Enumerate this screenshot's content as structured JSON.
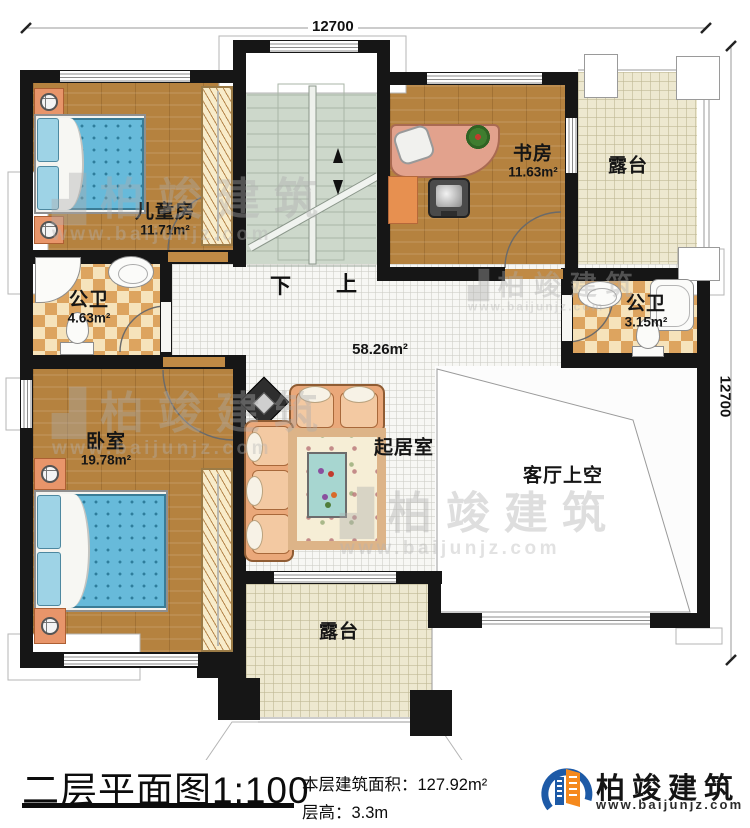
{
  "dimensions": {
    "top": "12700",
    "right": "12700"
  },
  "rooms": {
    "children": {
      "name": "儿童房",
      "area": "11.71m²"
    },
    "study": {
      "name": "书房",
      "area": "11.63m²"
    },
    "terrace_top": {
      "name": "露台"
    },
    "bath_left": {
      "name": "公卫",
      "area": "4.63m²"
    },
    "bath_right": {
      "name": "公卫",
      "area": "3.15m²"
    },
    "bedroom": {
      "name": "卧室",
      "area": "19.78m²"
    },
    "living": {
      "name": "起居室",
      "area": "58.26m²"
    },
    "void": {
      "name": "客厅上空"
    },
    "terrace_bottom": {
      "name": "露台"
    }
  },
  "stairs": {
    "down": "下",
    "up": "上"
  },
  "title_block": {
    "title": "二层平面图",
    "scale": "1:100",
    "area_label": "本层建筑面积：",
    "area_value": "127.92m²",
    "height_label": "层高：",
    "height_value": "3.3m"
  },
  "brand": {
    "name": "柏竣建筑",
    "url": "www.baijunjz.com"
  },
  "watermark": {
    "name": "柏竣建筑",
    "url": "www.baijunjz.com"
  },
  "colors": {
    "wall": "#161616",
    "wood_floor": "#b5823f",
    "stair_floor": "#cdd8cb",
    "terrace_floor": "#ede8d0",
    "bed_blue": "#67bada",
    "accent_blue": "#1d5aa7",
    "accent_orange": "#f5891d"
  }
}
